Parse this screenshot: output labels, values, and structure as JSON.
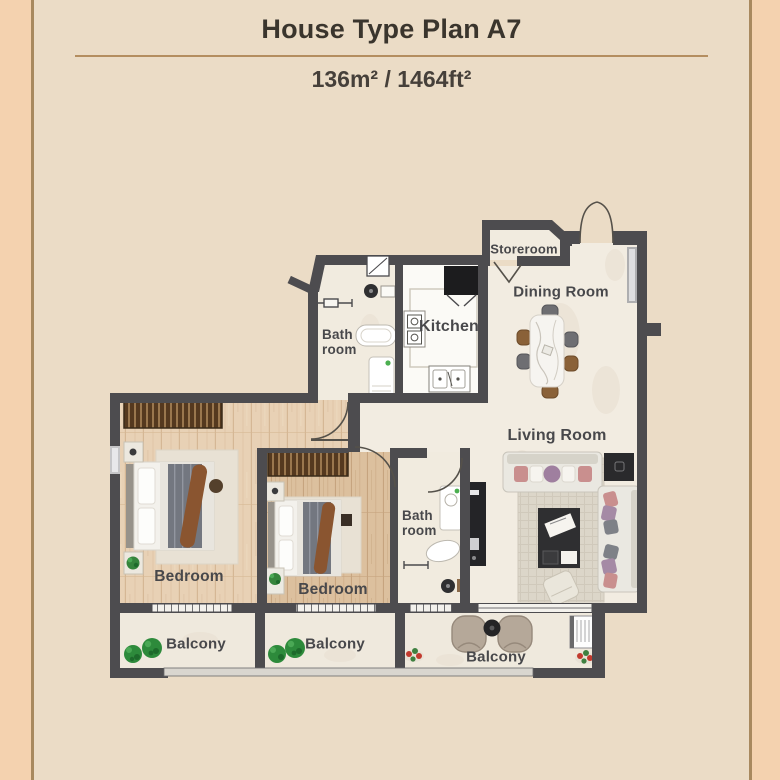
{
  "header": {
    "title": "House Type Plan A7",
    "area": "136m² / 1464ft²"
  },
  "plan": {
    "rooms": {
      "storeroom": {
        "label": "Storeroom"
      },
      "dining_room": {
        "label": "Dining Room"
      },
      "kitchen": {
        "label": "Kitchen"
      },
      "bathroom_upper": {
        "label": "Bath room"
      },
      "living_room": {
        "label": "Living Room"
      },
      "bedroom_left": {
        "label": "Bedroom"
      },
      "bedroom_middle": {
        "label": "Bedroom"
      },
      "bathroom_lower": {
        "label": "Bath room"
      },
      "balcony_left": {
        "label": "Balcony"
      },
      "balcony_middle": {
        "label": "Balcony"
      },
      "balcony_right": {
        "label": "Balcony"
      }
    },
    "colors": {
      "wall": "#4d4c4f",
      "frame_line": "#a8895e",
      "outer_background": "#f4d2af",
      "inner_background": "#ebdcc6",
      "marble_floor": "#f2ece1",
      "wood_floor_light": "#e8d1b5",
      "wood_floor_dark": "#dcc09e",
      "divider_rule": "#b48e60",
      "plant_green": "#2d8a3b",
      "flower_red": "#c23b2f"
    }
  }
}
